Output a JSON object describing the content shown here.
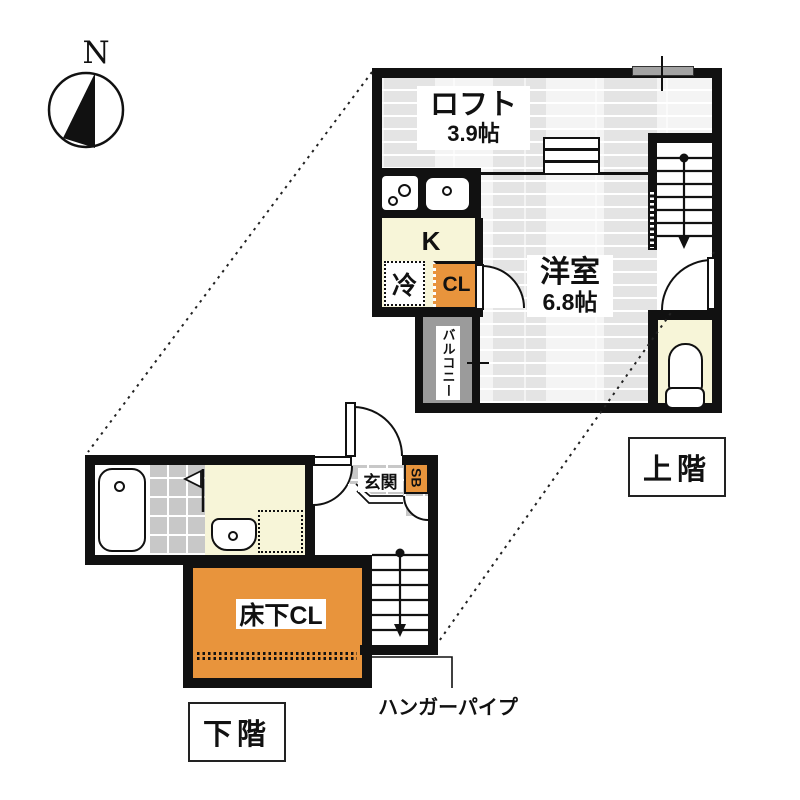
{
  "compass": {
    "label": "N"
  },
  "colors": {
    "wall": "#111111",
    "accent_orange": "#e8943c",
    "cream": "#f7f5d8",
    "tile_gray": "#c8c8c8",
    "balcony_gray": "#9b9b9b",
    "wood_floor": "#ececec"
  },
  "upper": {
    "tag": "上階",
    "loft_name": "ロフト",
    "loft_size": "3.9帖",
    "kitchen_label": "K",
    "fridge_label": "冷",
    "closet_label": "CL",
    "balcony_label": "バルコニー",
    "room_name": "洋室",
    "room_size": "6.8帖"
  },
  "lower": {
    "tag": "下階",
    "entrance_label": "玄関",
    "shoebox_label": "SB",
    "laundry_label": "洗",
    "underfloor_label": "床下CL",
    "hanger_pipe_label": "ハンガーパイプ"
  }
}
